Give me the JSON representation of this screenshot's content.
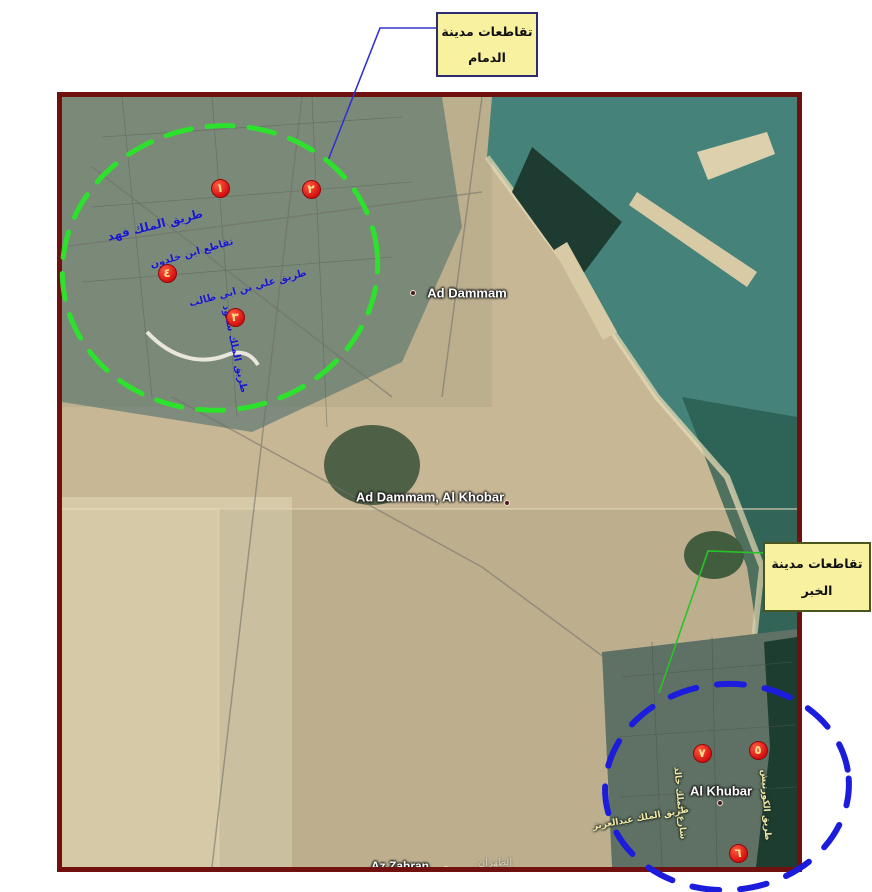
{
  "colors": {
    "map_border": "#70100f",
    "ellipse_dammam": "#2de22d",
    "ellipse_khobar": "#1c1cdc",
    "connector_dammam": "#3333cc",
    "connector_khobar": "#27c427",
    "marker_fill": "#d40f0f",
    "marker_text": "#ffdf8a",
    "callout_bg": "#f8f1a0",
    "road_label_dammam": "#1717cd",
    "road_label_khobar": "#efe6a6"
  },
  "callouts": {
    "dammam": {
      "line1": "تقاطعات مدينة",
      "line2": "الدمام"
    },
    "khobar": {
      "line1": "تقاطعات مدينة",
      "line2": "الخبر"
    }
  },
  "markers": [
    {
      "label": "١",
      "name": "intersection-1",
      "x": 158,
      "y": 91
    },
    {
      "label": "٢",
      "name": "intersection-2",
      "x": 249,
      "y": 92
    },
    {
      "label": "٣",
      "name": "intersection-3",
      "x": 173,
      "y": 220
    },
    {
      "label": "٤",
      "name": "intersection-4",
      "x": 105,
      "y": 176
    },
    {
      "label": "٥",
      "name": "intersection-5",
      "x": 696,
      "y": 653
    },
    {
      "label": "٦",
      "name": "intersection-6",
      "x": 676,
      "y": 756
    },
    {
      "label": "٧",
      "name": "intersection-7",
      "x": 640,
      "y": 656
    }
  ],
  "road_labels": [
    {
      "text": "طريق الملك فهد",
      "group": "dammam",
      "x": 93,
      "y": 128,
      "rot": -14,
      "size": 12
    },
    {
      "text": "تقاطع ابن خلدون",
      "group": "dammam",
      "x": 130,
      "y": 157,
      "rot": -16,
      "size": 10
    },
    {
      "text": "طريق علي بن ابي طالب",
      "group": "dammam",
      "x": 186,
      "y": 192,
      "rot": -15,
      "size": 10
    },
    {
      "text": "طريق الملك سعود",
      "group": "dammam",
      "x": 172,
      "y": 252,
      "rot": 78,
      "size": 10
    },
    {
      "text": "شارع الملك خالد",
      "group": "khobar",
      "x": 617,
      "y": 706,
      "rot": 85,
      "size": 9
    },
    {
      "text": "طريق الكورنيش",
      "group": "khobar",
      "x": 703,
      "y": 708,
      "rot": 87,
      "size": 9
    },
    {
      "text": "طريق الملك عبدالعزيز",
      "group": "khobar",
      "x": 579,
      "y": 722,
      "rot": -10,
      "size": 9
    }
  ],
  "place_labels": [
    {
      "text": "Ad Dammam",
      "x": 405,
      "y": 196,
      "size": 13,
      "dot": {
        "x": 351,
        "y": 196
      }
    },
    {
      "text": "Ad Dammam, Al Khobar",
      "x": 368,
      "y": 400,
      "size": 13,
      "dot": {
        "x": 445,
        "y": 406
      }
    },
    {
      "text": "Al Khubar",
      "x": 659,
      "y": 694,
      "size": 13,
      "dot": {
        "x": 658,
        "y": 706
      }
    },
    {
      "text": "Az Zahran",
      "x": 338,
      "y": 769,
      "size": 12,
      "dot": {
        "x": 384,
        "y": 772
      },
      "extra": {
        "text": "الظهران",
        "x": 433,
        "y": 766
      }
    }
  ]
}
